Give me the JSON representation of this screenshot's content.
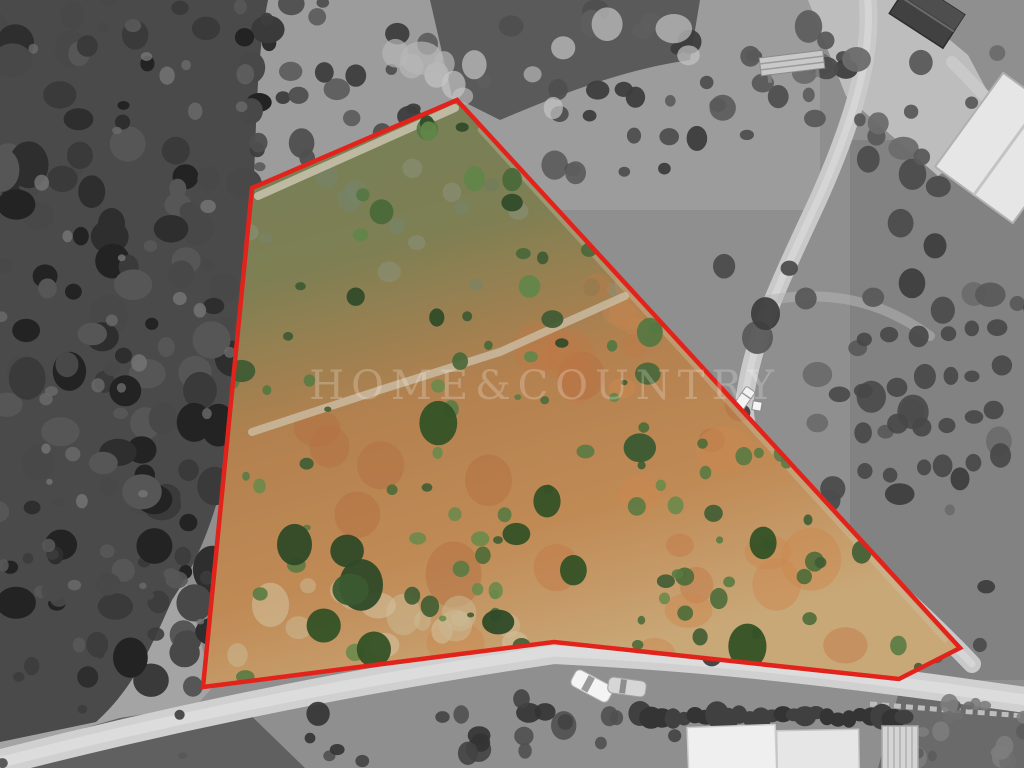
{
  "scene": {
    "description": "Aerial drone photograph of a land plot; the parcel is shown in colour and outlined in red while the surrounding terrain is desaturated to grayscale",
    "watermark_text": "HOME&COUNTRY"
  },
  "colors": {
    "boundary_red": "#e2231b",
    "parcel_green": "#55713f",
    "parcel_earth": "#c07b4c",
    "surroundings_gray": "#8f8f8f"
  }
}
